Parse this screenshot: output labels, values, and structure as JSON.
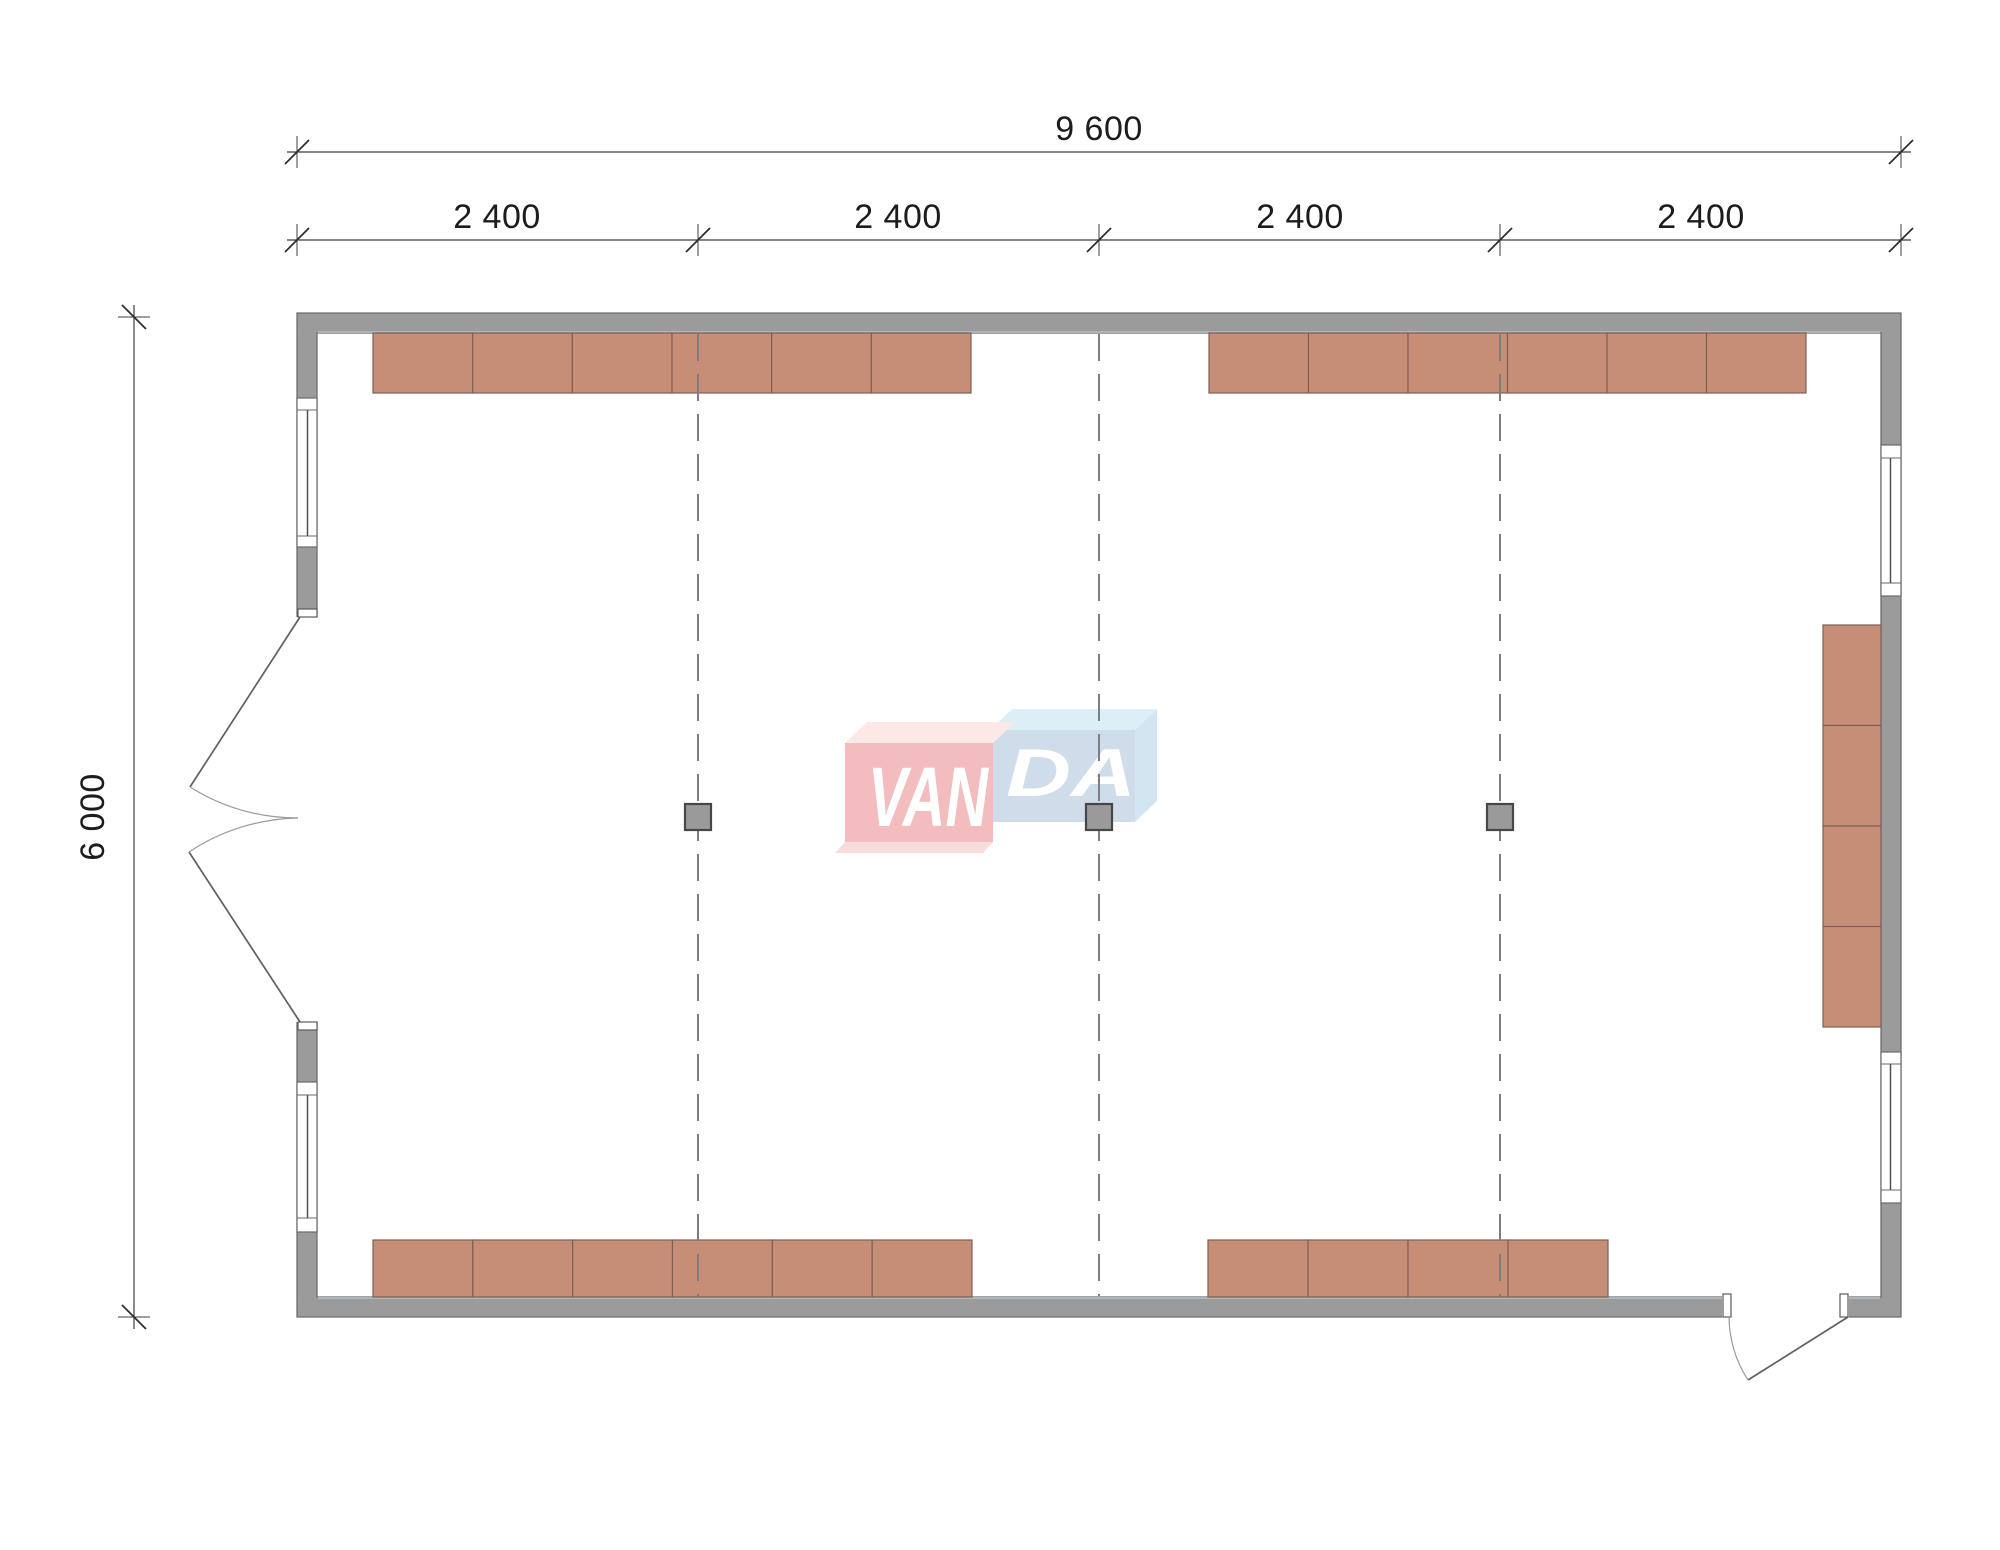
{
  "drawing": {
    "type": "floor-plan",
    "dimensions": {
      "total_width": "9 600",
      "segments": [
        "2 400",
        "2 400",
        "2 400",
        "2 400"
      ],
      "height": "6 000"
    }
  },
  "watermark": {
    "text_left": "VAN",
    "text_right": "DA"
  },
  "colors": {
    "wall": "#9b9b9b",
    "wall_outline": "#6e6e6e",
    "furniture": "#c78e77",
    "furniture_outline": "#7d6054",
    "grid": "#7d7d7d",
    "column": "#9a9a9a",
    "column_outline": "#474747",
    "dimension": "#3d3d3d",
    "wm_pink": "#f3b9bc",
    "wm_pink_top": "#fce8e6",
    "wm_pink_bottom": "#f9dbda",
    "wm_blue": "#ccdbe9",
    "wm_blue_top": "#daeef7",
    "wm_blue_side": "#cfe4f1",
    "wm_letters": "#ffffff"
  },
  "furniture": {
    "rows": [
      {
        "x": 373,
        "y": 333,
        "w": 598,
        "h": 60,
        "units": 6,
        "orientation": "h"
      },
      {
        "x": 1209,
        "y": 333,
        "w": 597,
        "h": 60,
        "units": 6,
        "orientation": "h"
      },
      {
        "x": 373,
        "y": 1240,
        "w": 599,
        "h": 57,
        "units": 6,
        "orientation": "h"
      },
      {
        "x": 1208,
        "y": 1240,
        "w": 400,
        "h": 57,
        "units": 4,
        "orientation": "h"
      },
      {
        "x": 1823,
        "y": 625,
        "w": 58,
        "h": 402,
        "units": 4,
        "orientation": "v"
      }
    ]
  },
  "grid": {
    "lines_x": [
      698,
      1099,
      1500
    ],
    "y1": 334,
    "y2": 1296
  },
  "columns": [
    {
      "x": 698,
      "y": 817
    },
    {
      "x": 1099,
      "y": 817
    },
    {
      "x": 1500,
      "y": 817
    }
  ],
  "column_size": 26
}
